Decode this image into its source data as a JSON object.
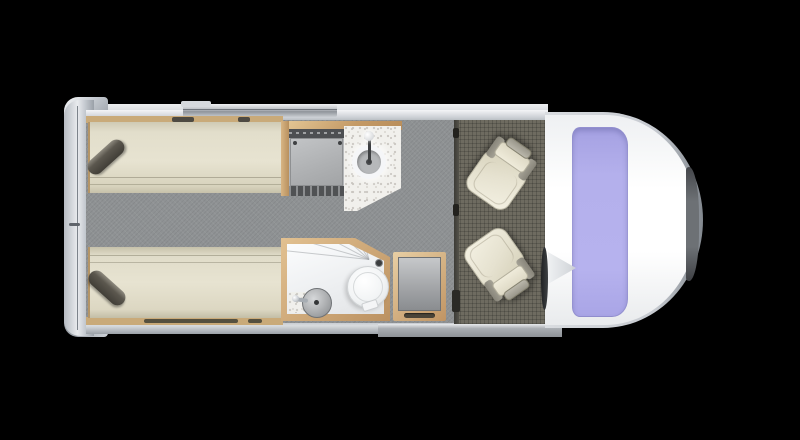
{
  "scene": {
    "kind": "campervan-floorplan-top-view",
    "canvas": {
      "width": 800,
      "height": 440
    },
    "orientation": "vehicle front on right, rear on left"
  },
  "colors": {
    "background": "#000000",
    "body_silver": "#c6cacf",
    "chrome_highlight": "#eef0f3",
    "cab_white": "#ffffff",
    "windshield_lavender": "#b4b0ec",
    "front_bumper_dark": "#55575a",
    "living_floor_gray": "#8f9294",
    "cab_floor_olive": "#6e6b60",
    "wood_tan": "#c9a674",
    "mattress_cream": "#e2decb",
    "pillow_dark": "#57544b",
    "counter_speckled": "#f1f0ec",
    "appliance_gray": "#b4b6b8",
    "appliance_dark": "#4d4f52",
    "shower_white": "#f7f8f9",
    "basin_gray": "#a9abad",
    "seat_cream": "#ece8d8",
    "seat_trim_gray": "#a19e91",
    "awning_bar": "#c3c7cc",
    "entry_step": "#a9adb2"
  },
  "components": [
    {
      "name": "rear-doors"
    },
    {
      "name": "awning-bar"
    },
    {
      "name": "twin-bed-top",
      "pillow": true
    },
    {
      "name": "twin-bed-bottom",
      "pillow": true
    },
    {
      "name": "kitchen-hob-unit"
    },
    {
      "name": "kitchen-counter"
    },
    {
      "name": "kitchen-sink"
    },
    {
      "name": "bathroom-shower-tray"
    },
    {
      "name": "toilet"
    },
    {
      "name": "bathroom-basin"
    },
    {
      "name": "wardrobe"
    },
    {
      "name": "cab-seat-passenger",
      "swiveled": true
    },
    {
      "name": "cab-seat-driver",
      "swiveled": true
    },
    {
      "name": "steering-wheel"
    },
    {
      "name": "windshield"
    },
    {
      "name": "front-bumper"
    }
  ]
}
